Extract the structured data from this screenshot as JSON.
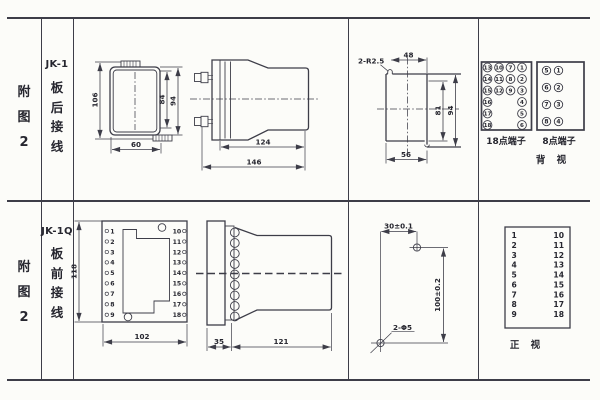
{
  "meta": {
    "bg": "#fcfcf9",
    "line_color": "#3d3d48",
    "text_color": "#26262f"
  },
  "header_top": {
    "fig": [
      "附",
      "图",
      "2"
    ],
    "model": "JK-1",
    "wiring": [
      "板",
      "后",
      "接",
      "线"
    ]
  },
  "header_bottom": {
    "fig": [
      "附",
      "图",
      "2"
    ],
    "model": "JK-1Q",
    "wiring": [
      "板",
      "前",
      "接",
      "线"
    ]
  },
  "rear_view": {
    "dim_height": "106",
    "dim_inner": "84",
    "dim_outer": "94",
    "dim_width": "60"
  },
  "rear_side": {
    "dim_body": "124",
    "dim_total": "146"
  },
  "cutout": {
    "radius": "2-R2.5",
    "dim_top": "48",
    "dim_inner": "81",
    "dim_outer": "94",
    "dim_bottom": "56"
  },
  "back_view": {
    "label": "背 视",
    "block18": {
      "label": "18点端子",
      "col1": [
        "13",
        "14",
        "15",
        "16",
        "17",
        "18"
      ],
      "col2": [
        "10",
        "11",
        "12"
      ],
      "col3": [
        "7",
        "8",
        "9"
      ],
      "col4": [
        "1",
        "2",
        "3",
        "4",
        "5",
        "6"
      ]
    },
    "block8": {
      "label": "8点端子",
      "left": [
        "5",
        "6",
        "7",
        "8"
      ],
      "right": [
        "1",
        "2",
        "3",
        "4"
      ]
    }
  },
  "front_view": {
    "dim_height": "118",
    "dim_width": "102",
    "left": [
      "1",
      "2",
      "3",
      "4",
      "5",
      "6",
      "7",
      "8",
      "9"
    ],
    "right": [
      "10",
      "11",
      "12",
      "13",
      "14",
      "15",
      "16",
      "17",
      "18"
    ]
  },
  "front_side": {
    "dim_plate": "35",
    "dim_body": "121"
  },
  "drill": {
    "dim_x": "30±0.1",
    "dim_y": "100±0.2",
    "holes": "2-Φ5"
  },
  "front_panel": {
    "label": "正 视",
    "left": [
      "1",
      "2",
      "3",
      "4",
      "5",
      "6",
      "7",
      "8",
      "9"
    ],
    "right": [
      "10",
      "11",
      "12",
      "13",
      "14",
      "15",
      "16",
      "17",
      "18"
    ]
  }
}
